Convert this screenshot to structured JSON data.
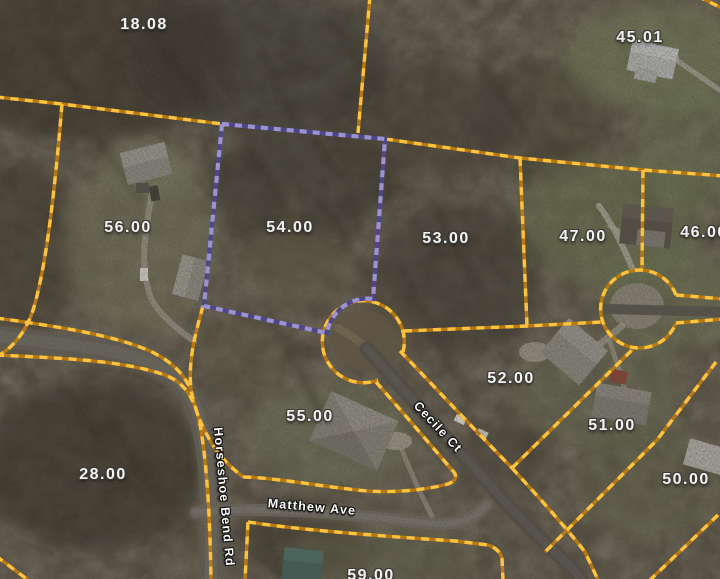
{
  "map": {
    "type": "parcel-gis-aerial-view",
    "colors": {
      "parcel_line": "#f5a829",
      "parcel_line_bright_dash": "#ffc23d",
      "highlight_line": "#8579c4",
      "highlight_dash": "#9c92cf",
      "label_text": "#f4f2ee",
      "road": "#5f5c55"
    },
    "highlighted_parcel_label": "54.00",
    "cul_de_sac_count": 2
  },
  "parcels": [
    {
      "label": "18.08",
      "highlighted": false
    },
    {
      "label": "45.01",
      "highlighted": false
    },
    {
      "label": "56.00",
      "highlighted": false
    },
    {
      "label": "54.00",
      "highlighted": true
    },
    {
      "label": "53.00",
      "highlighted": false
    },
    {
      "label": "47.00",
      "highlighted": false
    },
    {
      "label": "46.00",
      "highlighted": false
    },
    {
      "label": "52.00",
      "highlighted": false
    },
    {
      "label": "51.00",
      "highlighted": false
    },
    {
      "label": "50.00",
      "highlighted": false
    },
    {
      "label": "55.00",
      "highlighted": false
    },
    {
      "label": "28.00",
      "highlighted": false
    },
    {
      "label": "59.00",
      "highlighted": false
    }
  ],
  "streets": [
    {
      "name": "Horseshoe Bend Rd"
    },
    {
      "name": "Matthew Ave"
    },
    {
      "name": "Cecile Ct"
    }
  ]
}
